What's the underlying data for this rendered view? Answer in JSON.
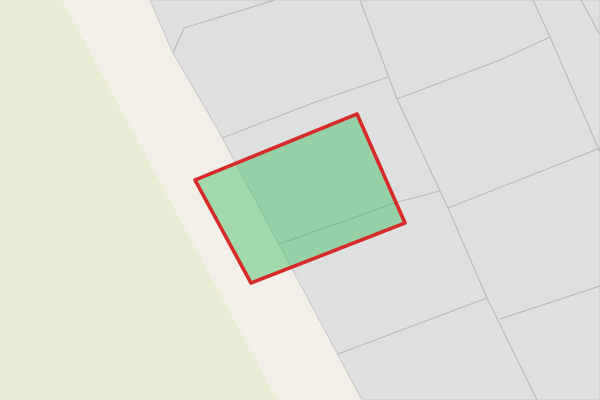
{
  "map": {
    "description": "Cadastral base map with one selected parcel highlighted in green with a red outline, a road band running diagonally and a grass area on the left",
    "canvas": {
      "width": 600,
      "height": 400
    },
    "colors": {
      "road_background": "#f2efe9",
      "grass_fill": "#e9edd5",
      "parcel_block_fill": "#dfdfdf",
      "road_edge_line": "#c8c8c8",
      "parcel_boundary_line": "#b9b9b9",
      "highlight_fill": "rgba(40,185,80,0.40)",
      "highlight_stroke": "#d62b28"
    },
    "shapes": [
      {
        "name": "road-area",
        "type": "rect",
        "fill": "#f2efe9",
        "interactable": false
      },
      {
        "name": "grass-area",
        "type": "polygon",
        "points": "0,0 62,0 277,400 0,400",
        "fill": "#e9edd5",
        "interactable": false
      },
      {
        "name": "parcel-block",
        "type": "polygon",
        "points": "150,0 600,0 600,400 362,400 218,130 173,53",
        "fill": "#dfdfdf",
        "stroke": "#c8c8c8",
        "stroke_width": 1,
        "interactable": false
      },
      {
        "name": "parcel-line-notch",
        "type": "polyline",
        "points": "275,0 184,28 173,53",
        "stroke": "#b9b9b9",
        "stroke_width": 1.1,
        "interactable": false
      },
      {
        "name": "parcel-line-main-steep",
        "type": "polyline",
        "points": "360,0 397,99 448,208 487,298 537,400",
        "stroke": "#b9b9b9",
        "stroke_width": 1.1,
        "interactable": false
      },
      {
        "name": "parcel-line-above-selection",
        "type": "polyline",
        "points": "222,138 313,103 388,77",
        "stroke": "#b9b9b9",
        "stroke_width": 1.1,
        "interactable": false
      },
      {
        "name": "parcel-line-upper-cross",
        "type": "polyline",
        "points": "397,99 500,60 550,37",
        "stroke": "#b9b9b9",
        "stroke_width": 1.1,
        "interactable": false
      },
      {
        "name": "parcel-line-topright-steep",
        "type": "polyline",
        "points": "533,0 550,37 600,152",
        "stroke": "#b9b9b9",
        "stroke_width": 1.1,
        "interactable": false
      },
      {
        "name": "parcel-line-corner-topright",
        "type": "polyline",
        "points": "581,0 600,35",
        "stroke": "#b9b9b9",
        "stroke_width": 1.1,
        "interactable": false
      },
      {
        "name": "parcel-line-mid-cross",
        "type": "polyline",
        "points": "448,208 600,148",
        "stroke": "#b9b9b9",
        "stroke_width": 1.1,
        "interactable": false
      },
      {
        "name": "parcel-line-under-selection",
        "type": "polyline",
        "points": "279,244 398,202 440,191",
        "stroke": "#b9b9b9",
        "stroke_width": 1.1,
        "interactable": false
      },
      {
        "name": "parcel-line-lower-cross",
        "type": "polyline",
        "points": "338,354 487,298",
        "stroke": "#b9b9b9",
        "stroke_width": 1.1,
        "interactable": false
      },
      {
        "name": "parcel-line-bottomright-cross",
        "type": "polyline",
        "points": "500,319 600,286",
        "stroke": "#b9b9b9",
        "stroke_width": 1.1,
        "interactable": false
      },
      {
        "name": "selected-parcel",
        "type": "polygon",
        "points": "357,114 405,223 251,283 195,180",
        "fill": "rgba(40,185,80,0.40)",
        "stroke": "#d62b28",
        "stroke_width": 3.6,
        "interactable": true
      }
    ]
  }
}
